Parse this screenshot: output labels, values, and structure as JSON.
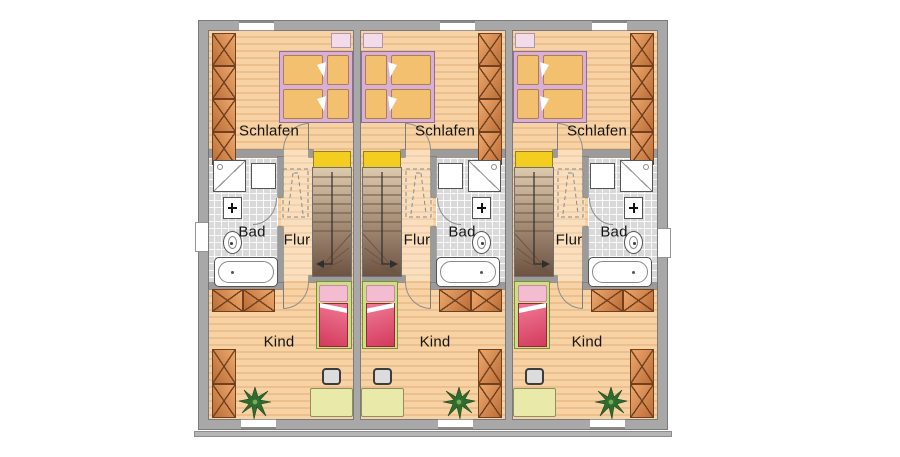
{
  "floorplan": {
    "type": "row-house upper floor plan, three units",
    "units": [
      {
        "id": "house-1",
        "mirrored": true,
        "rooms": {
          "bedroom": "Schlafen",
          "bath": "Bad",
          "hall": "Flur",
          "child": "Kind"
        }
      },
      {
        "id": "house-2",
        "mirrored": false,
        "rooms": {
          "bedroom": "Schlafen",
          "bath": "Bad",
          "hall": "Flur",
          "child": "Kind"
        }
      },
      {
        "id": "house-3",
        "mirrored": false,
        "rooms": {
          "bedroom": "Schlafen",
          "bath": "Bad",
          "hall": "Flur",
          "child": "Kind"
        }
      }
    ],
    "colors": {
      "wall": "#a8a8a8",
      "wood_floor": "#f7d2a4",
      "wood_floor_stripe": "#edbf8c",
      "hall_floor": "#fadfbf",
      "bath_tile": "#d9d9d9",
      "stair_landing": "#f3cd1f",
      "stair_dark": "#6e5342",
      "bed_frame": "#d9aed9",
      "mattress": "#f3c070",
      "kid_bed_frame": "#cdde8a",
      "kid_bed_duvet": "#d33a5c",
      "wardrobe": "#d98d4e",
      "desk": "#e9e9a9",
      "plant": "#2f6d2f"
    }
  }
}
